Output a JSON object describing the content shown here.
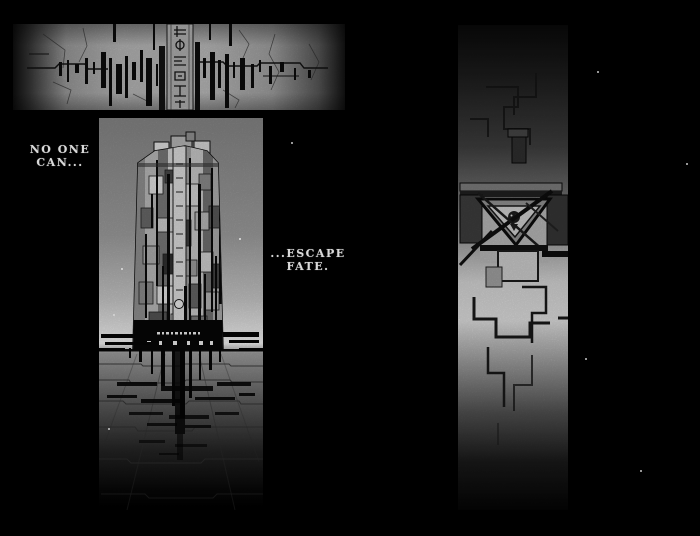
{
  "page": {
    "background_color": "#000000",
    "caption_color": "#d9d9d9"
  },
  "captions": [
    {
      "name": "caption-no-one-can",
      "lines": [
        "NO ONE",
        "CAN..."
      ]
    },
    {
      "name": "caption-escape-fate",
      "lines": [
        "...ESCAPE",
        "FATE."
      ]
    }
  ],
  "panels": [
    {
      "name": "panel-cracked-wall",
      "alt": "wide panel of a cracked stone wall with dark dripping stains and a glyph-inscribed column"
    },
    {
      "name": "panel-monolith-tower",
      "alt": "tall panel of a paneled cylindrical tower on a tiled plaza, black stains spreading from its base"
    },
    {
      "name": "panel-seal-wall",
      "alt": "tall panel of a wall with stepped cracks and a triangular mechanical seal"
    }
  ]
}
